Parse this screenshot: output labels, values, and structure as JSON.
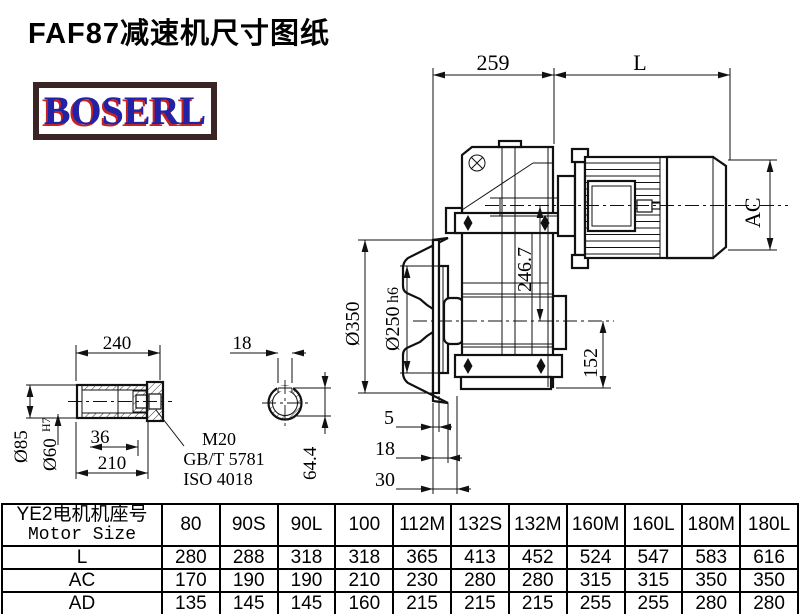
{
  "title": "FAF87减速机尺寸图纸",
  "logo": {
    "text": "BOSERL",
    "text_color": "#2222a6",
    "shadow_color": "#c42323",
    "border_color": "#3a2424"
  },
  "drawing": {
    "dims": {
      "w259": "259",
      "L": "L",
      "AC": "AC",
      "dia350": "Ø350",
      "dia250": "Ø250",
      "dia250fit": "h6",
      "h246": "246.7",
      "h152": "152",
      "o5": "5",
      "o18": "18",
      "o30": "30",
      "len240": "240",
      "key18": "18",
      "dia85": "Ø85",
      "dia60": "Ø60",
      "dia60fit": "H7",
      "dep36": "36",
      "len210": "210",
      "thread": "M20",
      "std_gb": "GB/T 5781",
      "std_iso": "ISO 4018",
      "key644": "64.4"
    }
  },
  "table": {
    "header_cn": "YE2电机机座号",
    "header_en": "Motor Size",
    "columns": [
      "80",
      "90S",
      "90L",
      "100",
      "112M",
      "132S",
      "132M",
      "160M",
      "160L",
      "180M",
      "180L"
    ],
    "rows": [
      {
        "label": "L",
        "values": [
          280,
          288,
          318,
          318,
          365,
          413,
          452,
          524,
          547,
          583,
          616
        ]
      },
      {
        "label": "AC",
        "values": [
          170,
          190,
          190,
          210,
          230,
          280,
          280,
          315,
          315,
          350,
          350
        ]
      },
      {
        "label": "AD",
        "values": [
          135,
          145,
          145,
          160,
          215,
          215,
          215,
          255,
          255,
          280,
          280
        ]
      }
    ]
  }
}
